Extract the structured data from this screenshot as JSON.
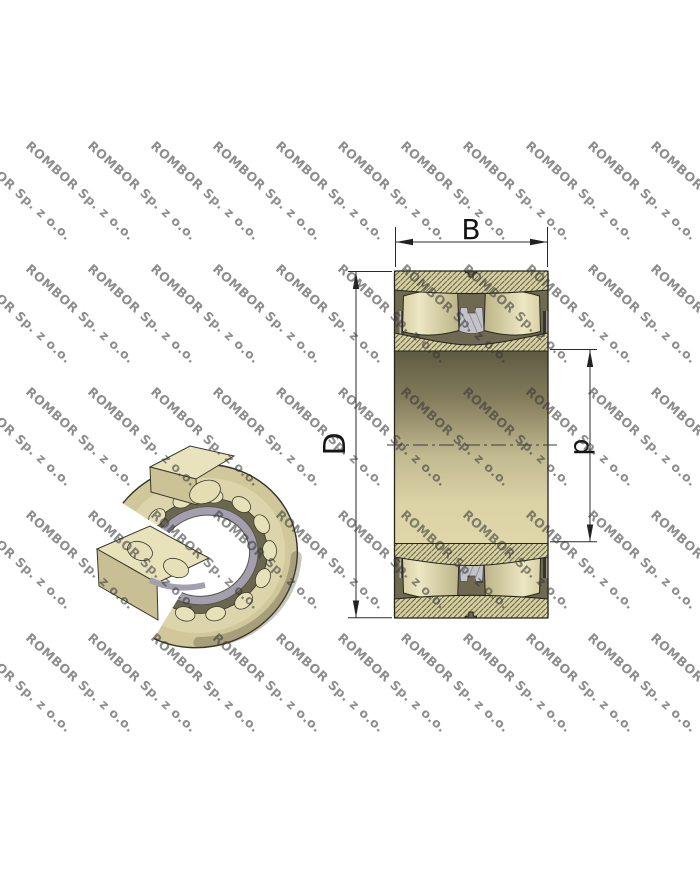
{
  "page": {
    "background": "#ffffff",
    "kind": "bearing technical drawing with watermark"
  },
  "watermark": {
    "text": "ROMBOR Sp. z o.o.",
    "color": "#8a8a8a",
    "rows": 5,
    "cols": 12
  },
  "views": {
    "iso_view": {
      "name": "bearing-3d-cutaway"
    },
    "section_view": {
      "name": "bearing-cross-section"
    }
  },
  "dimensions": {
    "width_label": "B",
    "outer_diameter_label": "D",
    "bore_label": "d"
  },
  "colors": {
    "ring_fill": "#d8d1a2",
    "hatch_line": "#5f5b42",
    "roller_light": "#ece6c2",
    "roller_dark": "#bcb487",
    "cavity_dark": "#6e6950",
    "cage_strip_dark": "#35332a",
    "guide_ring_gray": "#c4c3c9",
    "bore_dark": "#5f5a43",
    "bore_light": "#ded6a8",
    "outline": "#26251c",
    "dimension_line": "#2b2b2b",
    "hole_white": "#ffffff",
    "cage_band_gray": "#a39fae"
  }
}
